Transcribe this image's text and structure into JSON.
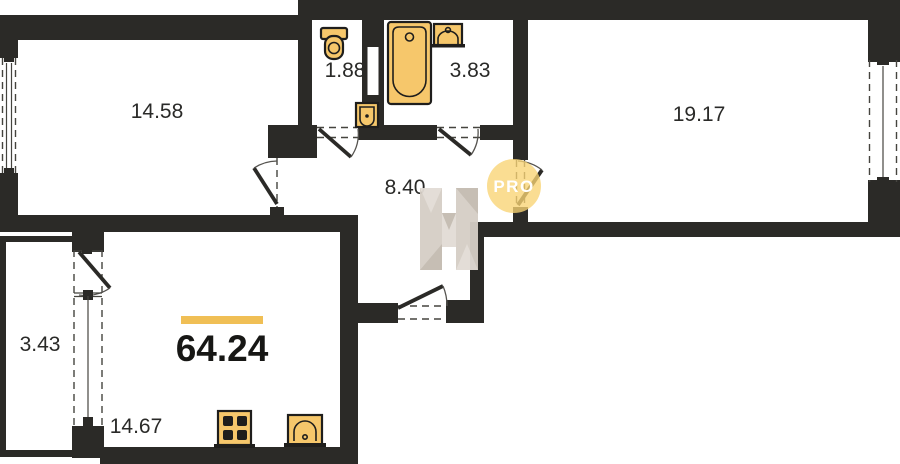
{
  "floor_plan": {
    "total_area": "64.24",
    "rooms": [
      {
        "id": "bedroom",
        "area": "14.58"
      },
      {
        "id": "wc",
        "area": "1.88"
      },
      {
        "id": "bathroom",
        "area": "3.83"
      },
      {
        "id": "living-room",
        "area": "19.17"
      },
      {
        "id": "hallway",
        "area": "8.40"
      },
      {
        "id": "balcony",
        "area": "3.43"
      },
      {
        "id": "kitchen-living",
        "area": "14.67"
      }
    ],
    "watermark": {
      "letter": "H",
      "badge": "PRO"
    },
    "colors": {
      "wall": "#2b2a27",
      "label": "#2a2a28",
      "fixture_fill": "#f6c76b",
      "fixture_stroke": "#1f1e1c",
      "accent_bar": "#f0bf55",
      "badge_fill": "#f8d473",
      "badge_text": "#ffffff",
      "watermark_light": "#e2dcd5",
      "watermark_mid": "#d5cec6",
      "watermark_dark": "#c3bbb1"
    }
  }
}
